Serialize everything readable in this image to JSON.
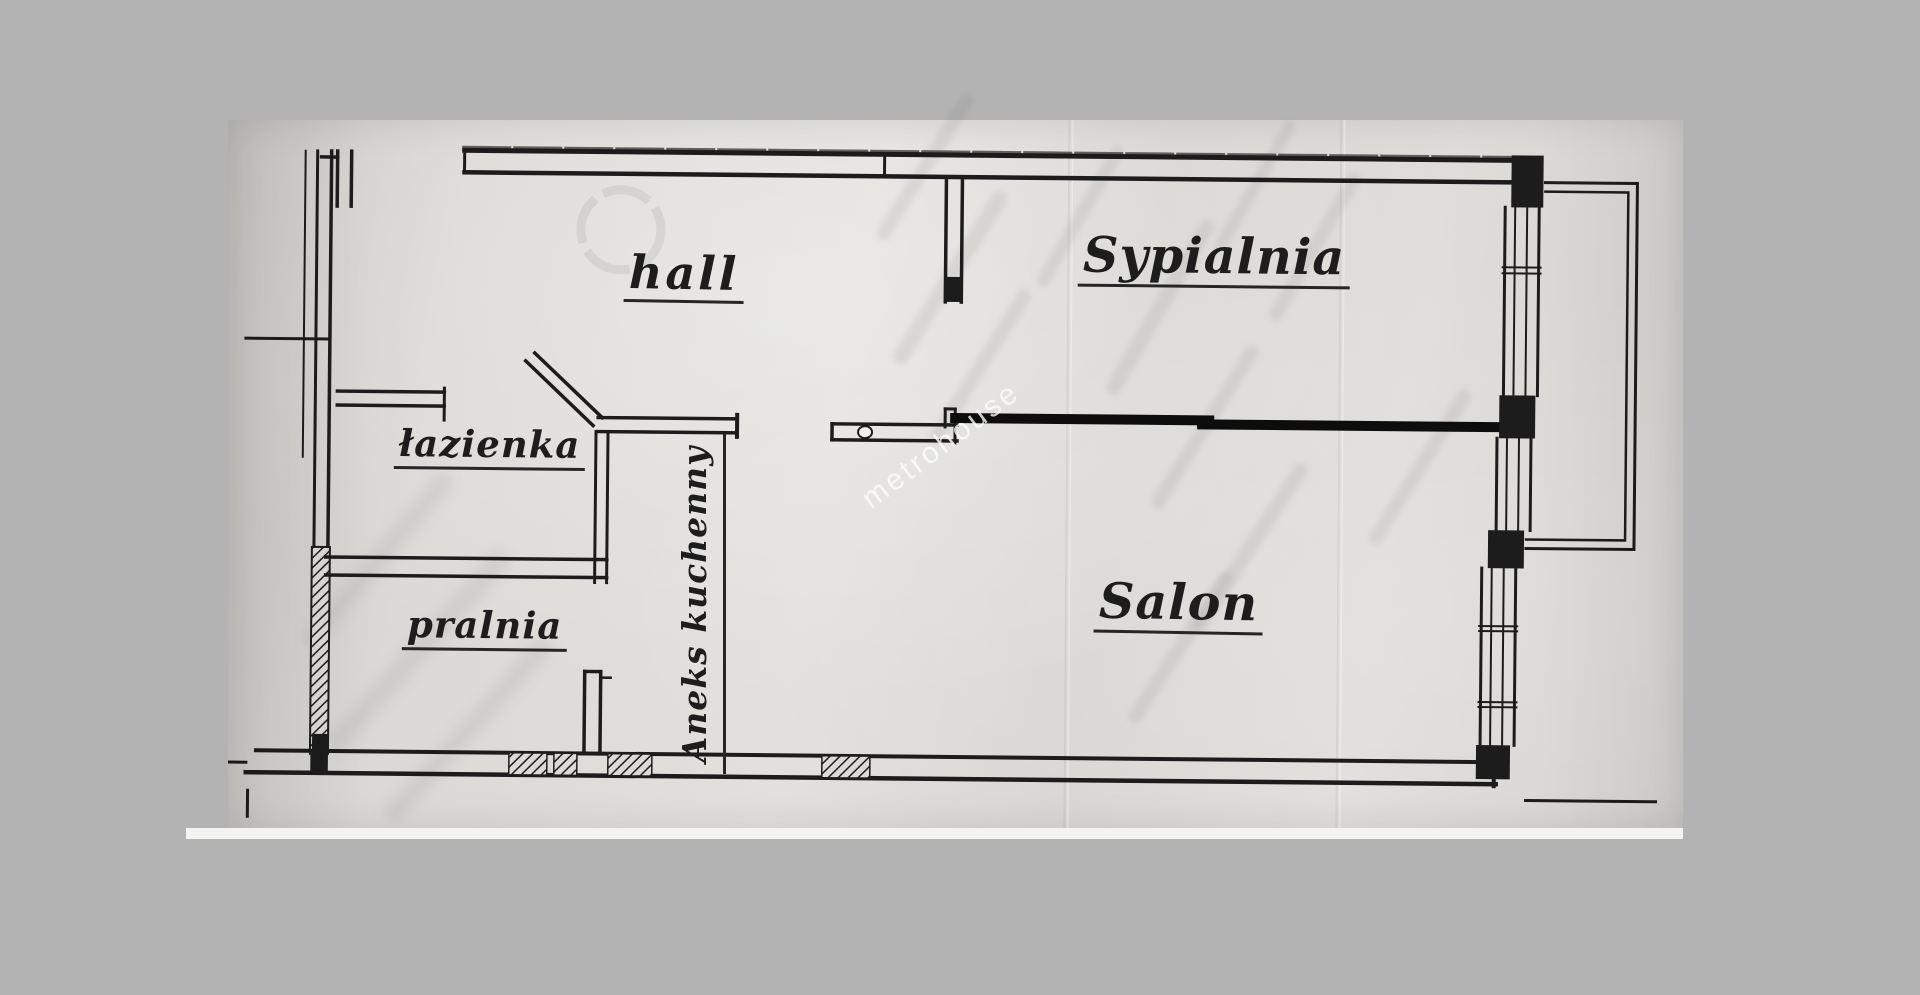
{
  "scene": {
    "type": "scanned apartment floor plan photograph",
    "background_color": "#b3b3b3",
    "paper_color": "#dcdad6",
    "ink_color": "#1c1c1c"
  },
  "floorplan": {
    "watermark": "metrohouse",
    "labels": {
      "hall": "hall",
      "bedroom": "Sypialnia",
      "bathroom": "łazienka",
      "laundry": "pralnia",
      "kitchenette": "Aneks kuchenny",
      "living_room": "Salon"
    }
  }
}
